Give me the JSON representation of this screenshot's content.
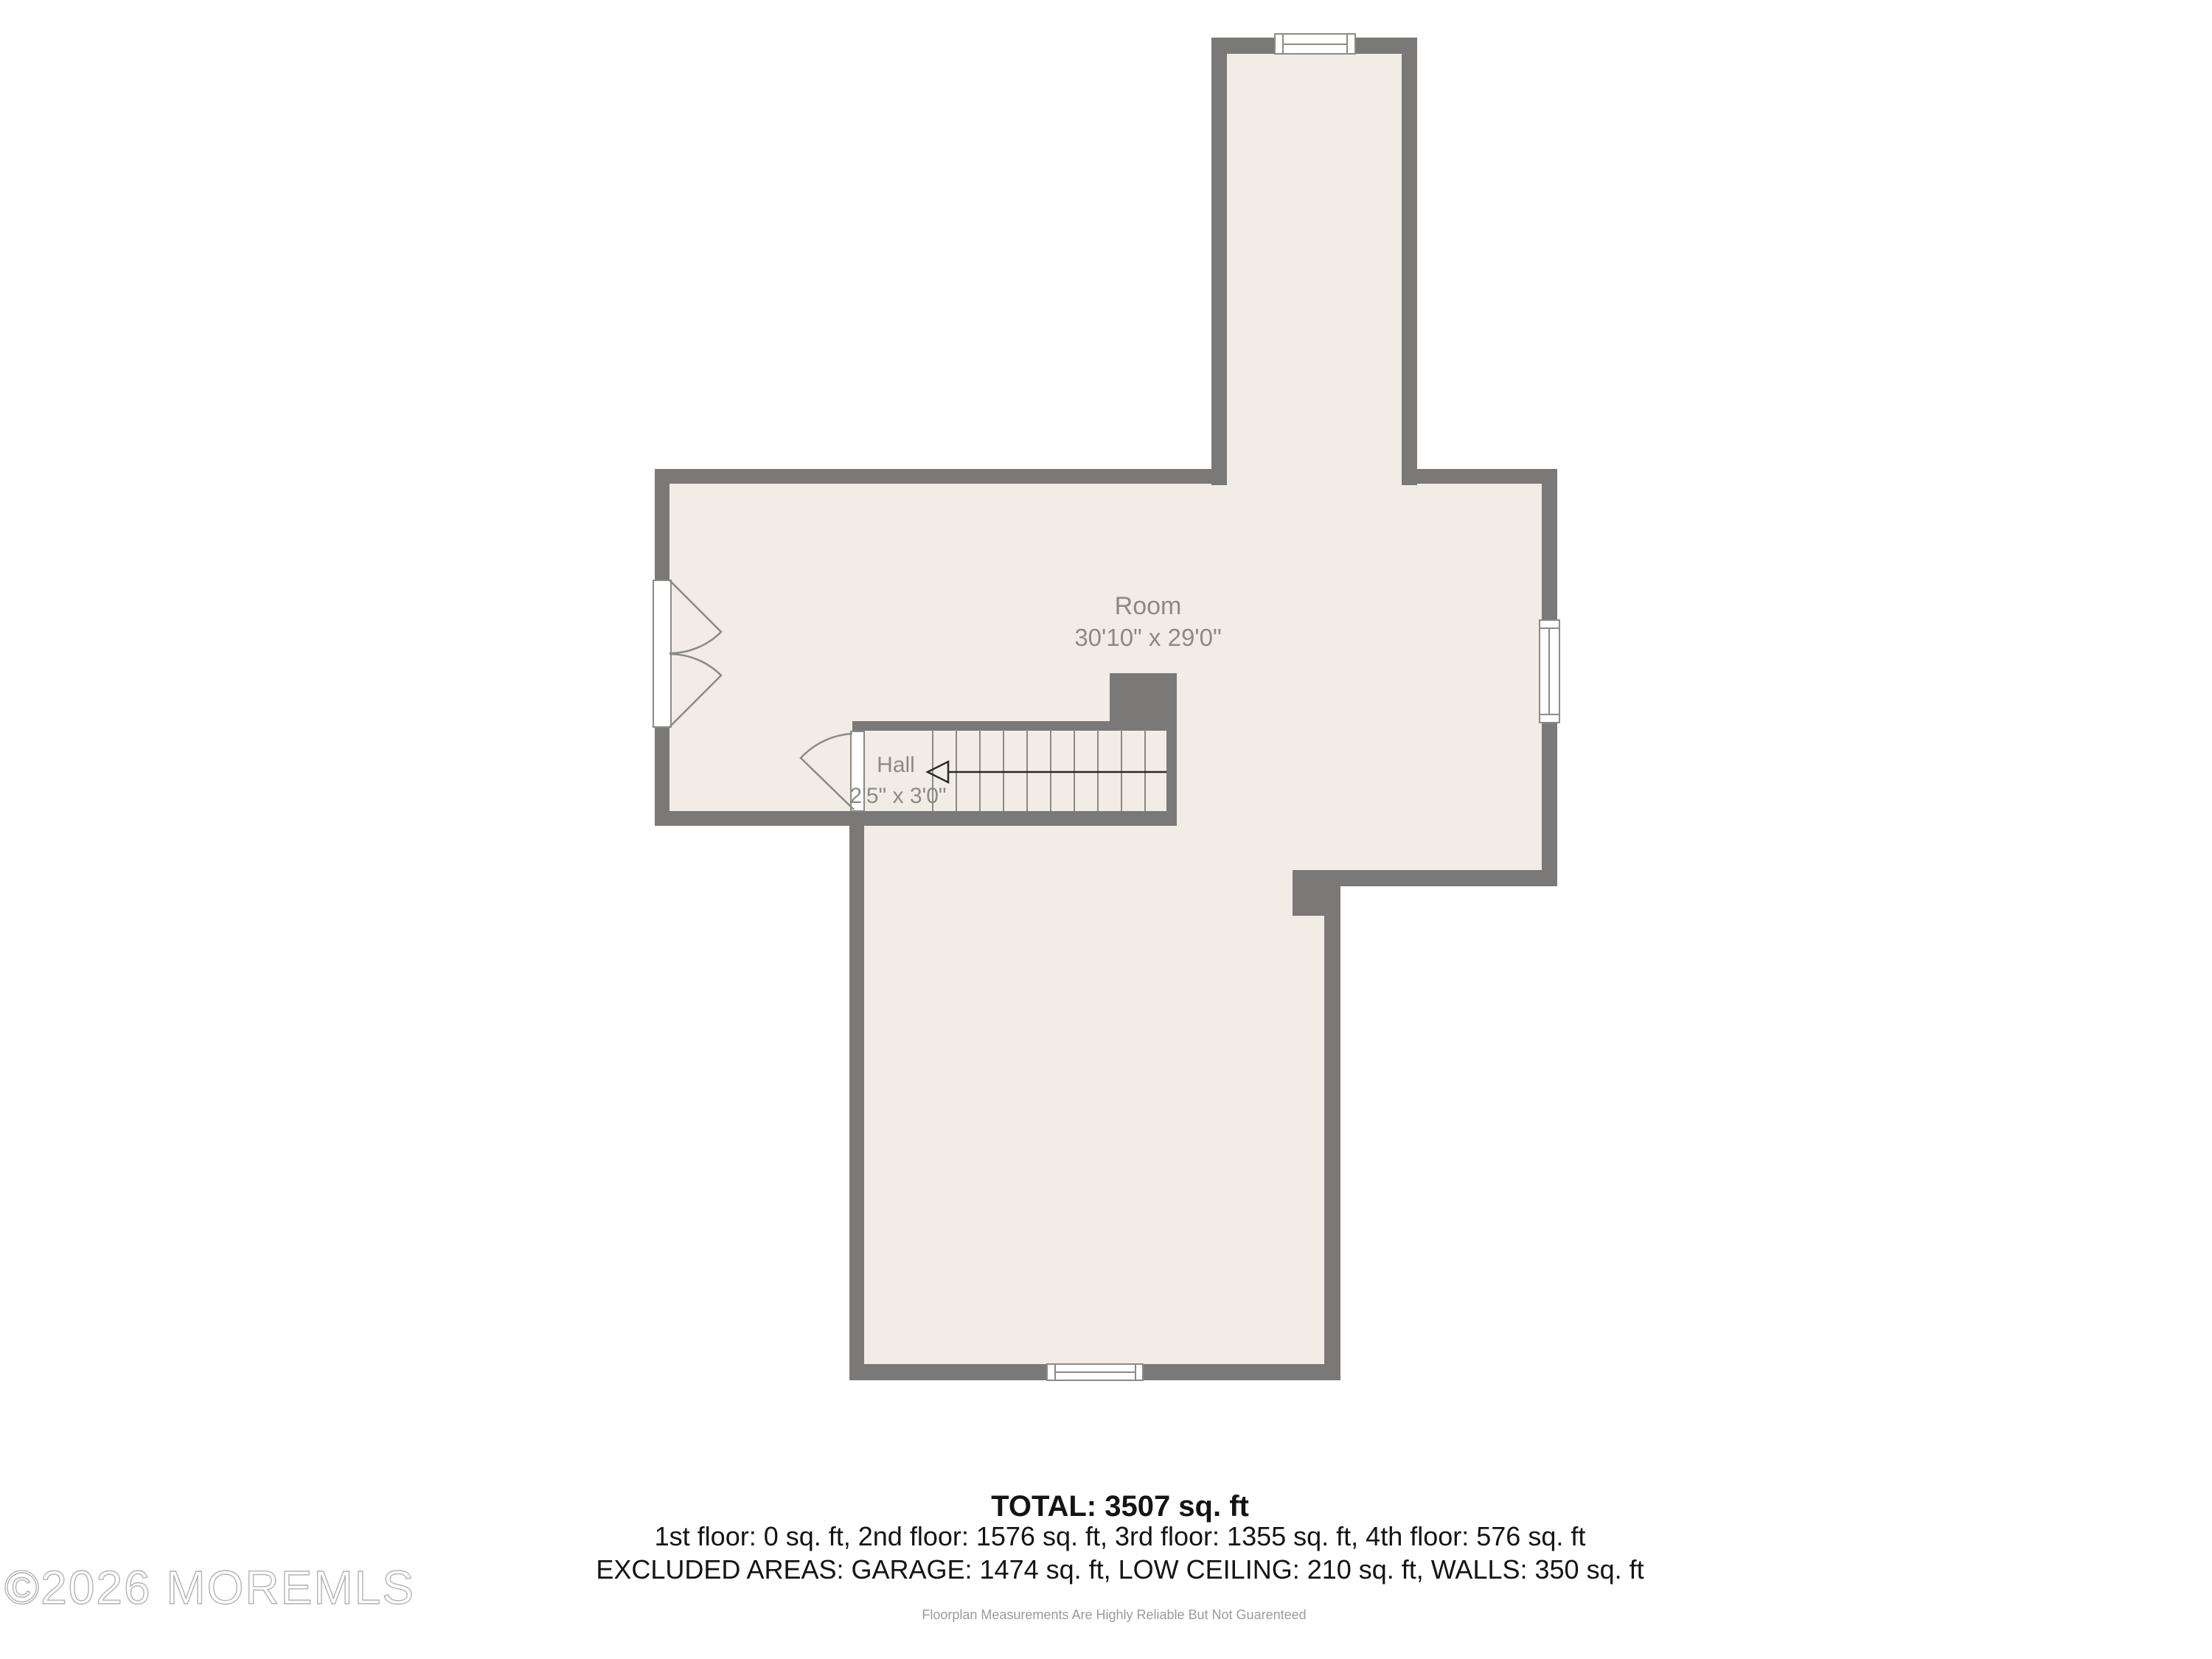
{
  "rooms": [
    {
      "name": "Room",
      "dimensions": "30'10\" x 29'0\""
    },
    {
      "name": "Hall",
      "dimensions": "2'5\" x 3'0\""
    }
  ],
  "summary": {
    "total_line": "TOTAL: 3507 sq. ft",
    "floors_line": "1st floor: 0 sq. ft, 2nd floor: 1576 sq. ft, 3rd floor: 1355 sq. ft, 4th floor: 576 sq. ft",
    "excluded_line": "EXCLUDED AREAS: GARAGE: 1474 sq. ft, LOW CEILING: 210 sq. ft, WALLS: 350 sq. ft"
  },
  "disclaimer": "Floorplan Measurements Are Highly Reliable But Not Guarenteed",
  "watermark": "©2026 MOREMLS",
  "icons": {
    "stair_arrow": "left-arrow-icon",
    "windows": [
      "top-window",
      "right-window",
      "bottom-window"
    ],
    "doors": [
      "double-french-door",
      "hall-single-door"
    ]
  },
  "colors": {
    "wall": "#7b7977",
    "floor": "#f2ece6",
    "symbol": "#8b8a86",
    "label": "#8c8a85",
    "summary": "#141414",
    "muted": "#9b9b9b",
    "watermark": "#b5b3b1",
    "arrow": "#2a2a2a",
    "bg": "#ffffff"
  }
}
